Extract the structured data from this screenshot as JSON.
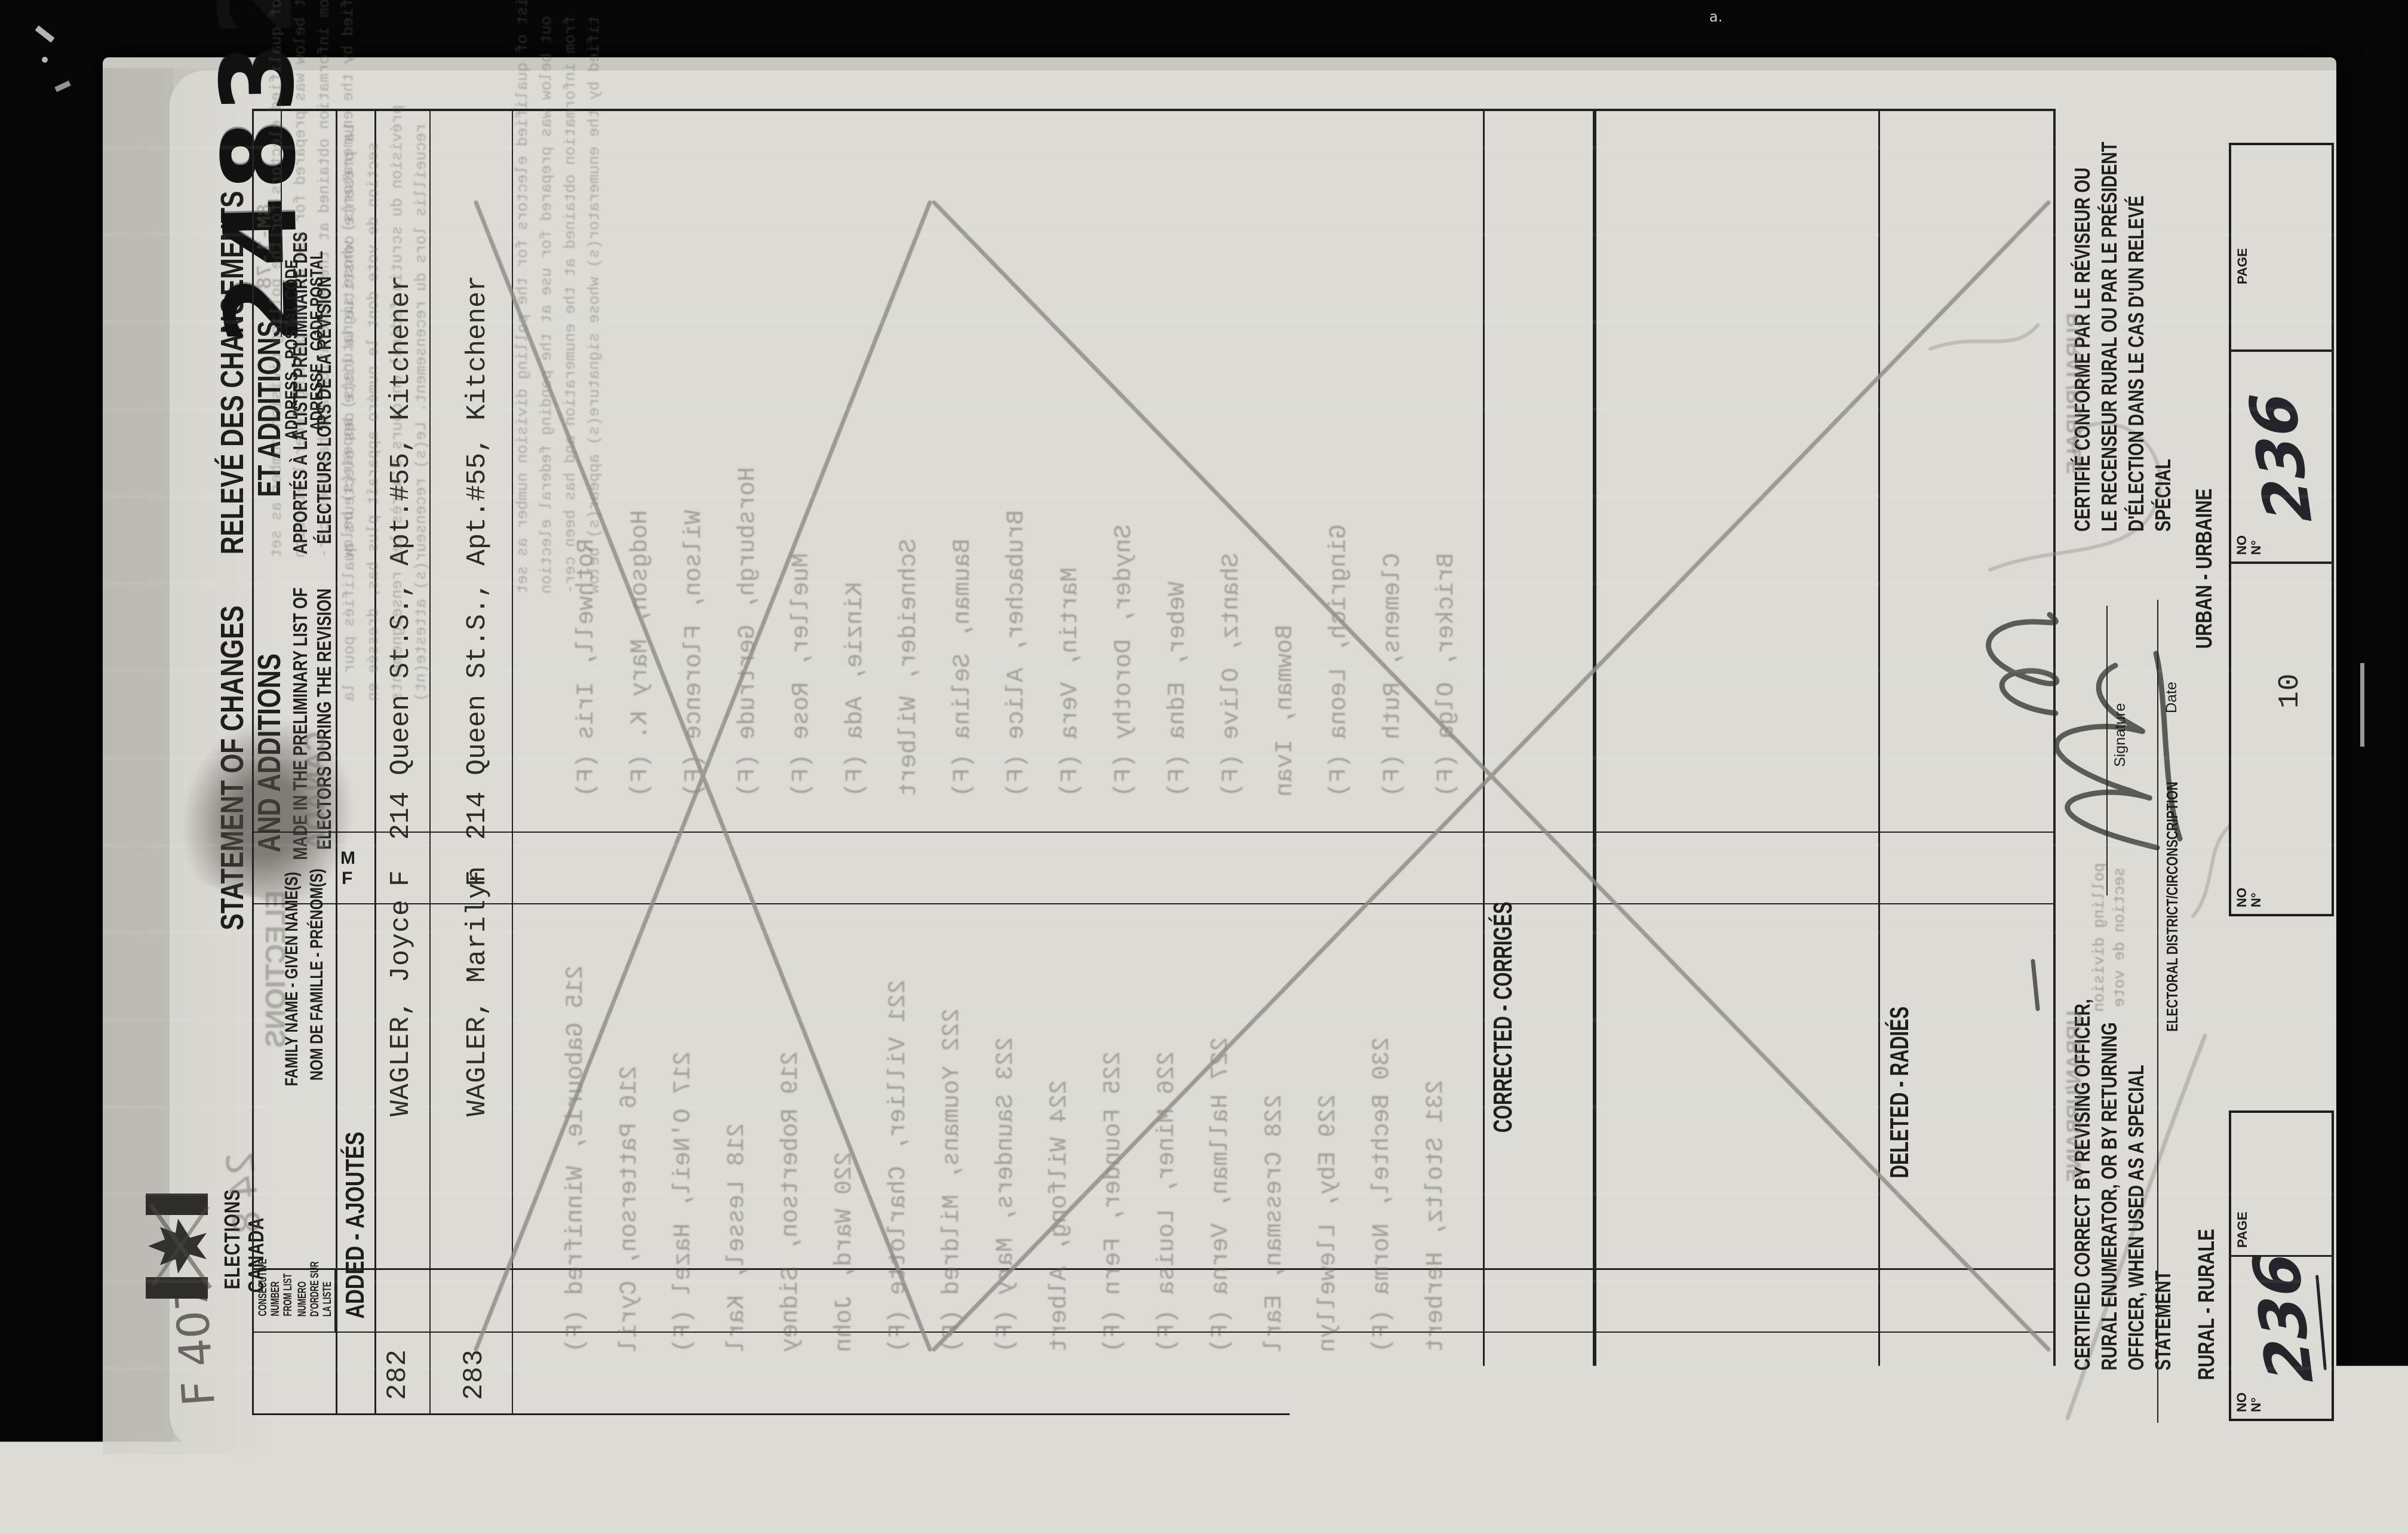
{
  "page": {
    "serial": "24832",
    "form_number_pencil": "F 407",
    "form_code_ghost": "8M-1-78",
    "film_mark": "a."
  },
  "logo": {
    "line1": "ELECTIONS",
    "line2": "CANADA"
  },
  "title": {
    "en1": "STATEMENT OF CHANGES",
    "en2": "AND ADDITIONS",
    "fr1": "RELEVÉ DES CHANGEMENTS",
    "fr2": "ET ADDITIONS",
    "sub_en1": "MADE IN THE PRELIMINARY LIST OF",
    "sub_en2": "ELECTORS DURING THE REVISION",
    "sub_fr1": "APPORTÉS À LA LISTE PRÉLIMINAIRE DES",
    "sub_fr2": "ÉLECTEURS LORS DE LA RÉVISION"
  },
  "table": {
    "consec_en_lines": [
      "CONSECUTIVE",
      "NUMBER",
      "FROM LIST"
    ],
    "consec_fr_lines": [
      "NUMERO",
      "D'ORDRE SUR",
      "LA LISTE"
    ],
    "col_name_en": "FAMILY NAME - GIVEN NAME(S)",
    "col_name_fr": "NOM DE FAMILLE - PRÉNOM(S)",
    "col_sex_m": "M",
    "col_sex_f": "F",
    "col_address_en": "ADDRESS - POSTAL CODE",
    "col_address_fr": "ADRESSE - CODE POSTAL"
  },
  "sections": {
    "added": "ADDED - AJOUTÉS",
    "corrected": "CORRECTED - CORRIGÉS",
    "deleted": "DELETED - RADIÉS"
  },
  "rows": [
    {
      "num": "282",
      "name": "WAGLER, Joyce",
      "sex": "F",
      "address": "214 Queen St.S., Apt.#55, Kitchener"
    },
    {
      "num": "283",
      "name": "WAGLER, Marilyn",
      "sex": "F",
      "address": "214 Queen St.S., Apt.#55, Kitchener"
    }
  ],
  "certification": {
    "en_lines": [
      "CERTIFIED CORRECT BY REVISING OFFICER,",
      "RURAL ENUMERATOR, OR BY RETURNING",
      "OFFICER, WHEN USED AS A SPECIAL",
      "STATEMENT"
    ],
    "fr_lines": [
      "CERTIFIÉ CONFORME PAR LE RÉVISEUR OU",
      "LE RECENSEUR RURAL OU PAR LE PRÉSIDENT",
      "D'ÉLECTION DANS LE CAS D'UN RELEVÉ",
      "SPÉCIAL"
    ],
    "signature_label": "Signature",
    "date_label": "Date",
    "district_label": "ELECTORAL DISTRICT/CIRCONSCRIPTION"
  },
  "footer": {
    "rural_label": "RURAL - RURALE",
    "urban_label": "URBAN - URBAINE",
    "no_en": "NO",
    "no_fr": "N°",
    "page_label": "PAGE",
    "rural_no_value_handwritten": "236",
    "urban_no_value": "10",
    "urban_page_value_handwritten": "236"
  },
  "bleedthrough": {
    "watermark1": "ELECTIONS",
    "watermark2": "CANADA",
    "rural_ghost": "RURAL/RURALE",
    "urban_ghost": "URBAN/URBAINE",
    "polling1": "polling division",
    "polling2": "section de vote",
    "pencil_ghost": "24 8",
    "paragraph_en": [
      "This list of qualified electors for the polling division number as set",
      "out below was prepared for use at the pending federal election",
      "from information obtained at the enumeration and has been cer-",
      "tified by the enumerator(s) whose signature(s) appear(s) below"
    ],
    "paragraph_fr": [
      "La présente constitue la liste des électeurs qualifiés pour la",
      "section de vote dont le numéro apparaît plus bas, dressée en",
      "prévision du scrutin fédéral en cours d'après les renseignements",
      "recueillis lors du recensement. Le(s) recenseur(s) atteste(nt)"
    ],
    "rows": [
      {
        "l": "215  Gabourie, Winnifred (F)",
        "r": "Rothwell, Iris (F)"
      },
      {
        "l": "216  Patterson, Cyril",
        "r": "Hodgson, Mary K. (F)"
      },
      {
        "l": "217  O'Neil, Hazel (F)",
        "r": "Wilson, Florence (F)"
      },
      {
        "l": "218  Lessel, Karl",
        "r": "Horsburgh, Gertrude (F)"
      },
      {
        "l": "219  Robertson, Sidney",
        "r": "Mueller, Rose (F)"
      },
      {
        "l": "220  Ward, John",
        "r": "Kinzie, Ada (F)"
      },
      {
        "l": "221  Villier, Charlotte (F)",
        "r": "Schneider, Wilbert"
      },
      {
        "l": "222  Youmans, Mildred (F)",
        "r": "Bauman, Selina (F)"
      },
      {
        "l": "223  Saunders, Mary (F)",
        "r": "Brubacher, Alice (F)"
      },
      {
        "l": "224  Wilfong, Albert",
        "r": "Martin, Vera (F)"
      },
      {
        "l": "225  Founder, Fern (F)",
        "r": "Snyder, Dorothy (F)"
      },
      {
        "l": "226  Miner, Louisa (F)",
        "r": "Weber, Edna (F)"
      },
      {
        "l": "227  Hallman, Verna (F)",
        "r": "Shantz, Olive (F)"
      },
      {
        "l": "228  Cressman, Earl",
        "r": "Bowman, Ivan"
      },
      {
        "l": "229  Eby, Llewellyn",
        "r": "Gingrich, Leona (F)"
      },
      {
        "l": "230  Bechtel, Norma (F)",
        "r": "Clemens, Ruth (F)"
      },
      {
        "l": "231  Stoltz, Herbert",
        "r": "Bricker, Olga (F)"
      }
    ]
  },
  "colors": {
    "background": "#070707",
    "paper": "#c9c8c2",
    "form_area": "#dcdbd5",
    "print": "#1d1d1c",
    "typewriter": "#2b2b28",
    "pencil": "#8d8a84",
    "ink": "#2c2c2a"
  }
}
